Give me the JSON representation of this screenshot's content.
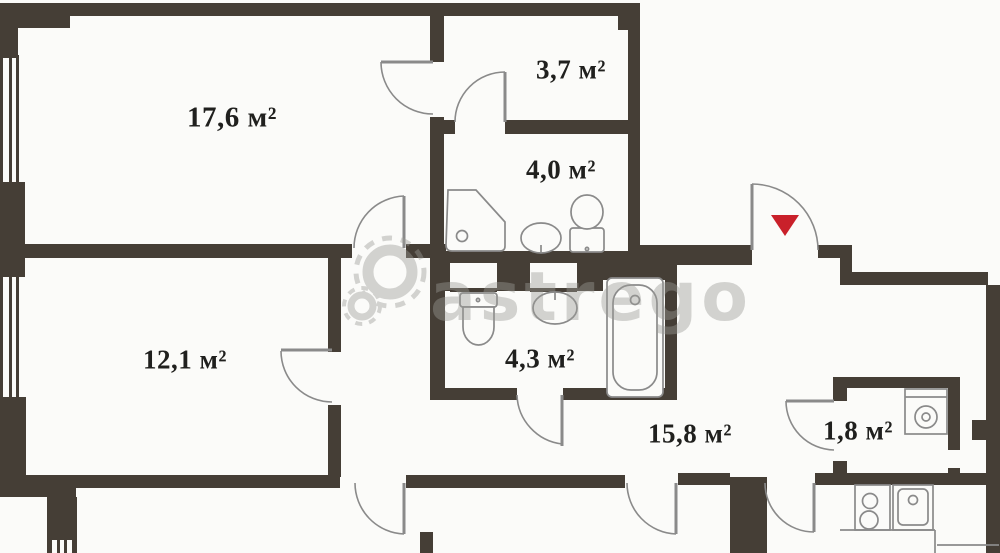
{
  "plan": {
    "title": "apartment-floor-plan",
    "rooms": {
      "living": {
        "label": "17,6 м²",
        "area_m2": 17.6
      },
      "wardrobe": {
        "label": "3,7 м²",
        "area_m2": 3.7
      },
      "bath_top": {
        "label": "4,0 м²",
        "area_m2": 4.0
      },
      "bedroom": {
        "label": "12,1 м²",
        "area_m2": 12.1
      },
      "bath_mid": {
        "label": "4,3 м²",
        "area_m2": 4.3
      },
      "hallway": {
        "label": "15,8 м²",
        "area_m2": 15.8
      },
      "storage": {
        "label": "1,8 м²",
        "area_m2": 1.8
      }
    },
    "watermark": {
      "text": "astrego",
      "color": "#c0c0bc"
    },
    "entrance_marker": {
      "shape": "triangle-down",
      "color": "#c9202a"
    },
    "colors": {
      "wall": "#453e36",
      "fixture_line": "#8a8a8a",
      "label_text": "#20201e",
      "background": "#fbfbf9"
    },
    "fixtures": [
      "shower-cabin",
      "washbasin-top",
      "toilet-top",
      "toilet-mid",
      "washbasin-mid",
      "bathtub",
      "washing-machine",
      "stove",
      "kitchen-sink"
    ]
  }
}
